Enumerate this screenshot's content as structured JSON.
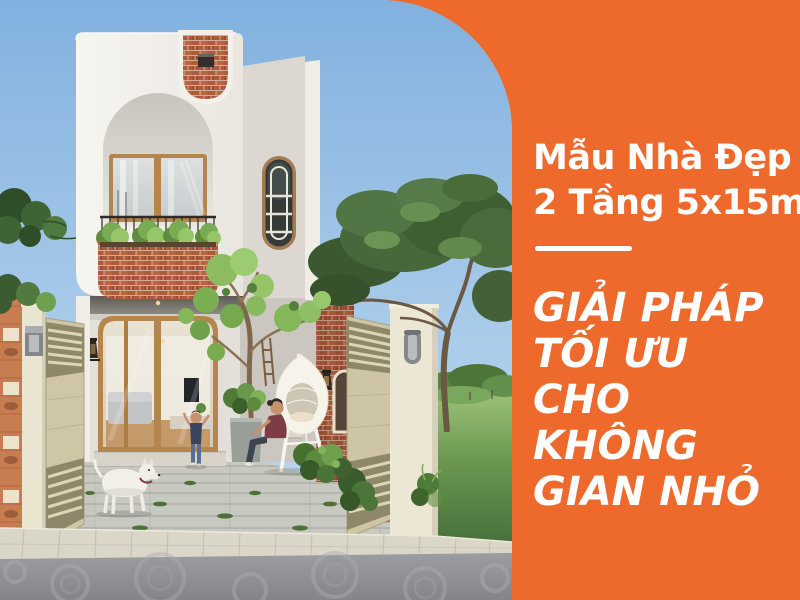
{
  "panel": {
    "title_line1": "Mẫu Nhà Đẹp",
    "title_line2": "2 Tầng 5x15m",
    "heading_lines": [
      "GIẢI PHÁP",
      "TỐI ƯU",
      "CHO",
      "KHÔNG",
      "GIAN NHỎ"
    ]
  },
  "colors": {
    "accent_orange": "#ED6A2C",
    "text_white": "#FFFFFF",
    "sky_blue": "#8AB7E2",
    "facade_white": "#F4F2ED",
    "brick_red": "#AF5A3C",
    "lawn_green": "#6B9750"
  }
}
